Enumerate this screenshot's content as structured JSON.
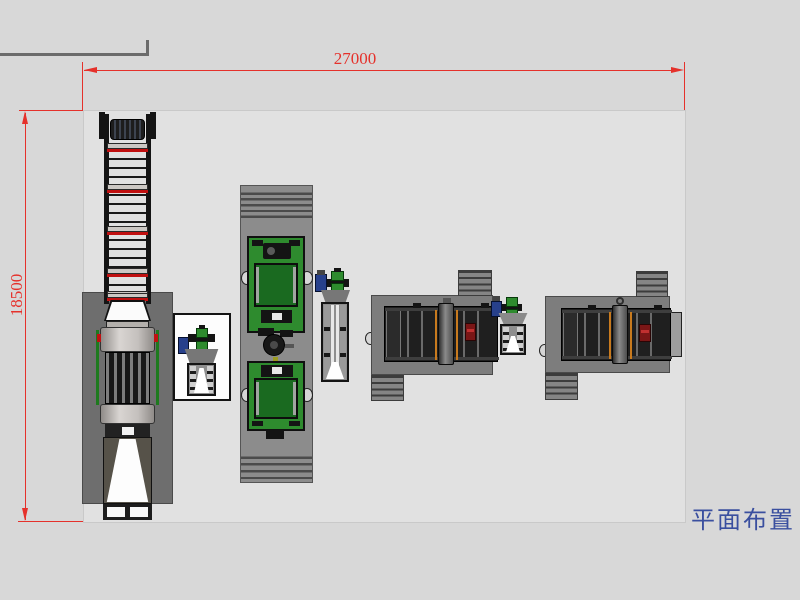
{
  "drawing": {
    "caption": "平面布置",
    "caption_color": "#3a4f9f",
    "dimension_color": "#e5312b",
    "dim_top_label": "27000",
    "dim_left_label": "18500",
    "outer_bg": "#d8d8d8",
    "area_bg": "#e1e1e1"
  },
  "palette": {
    "pad_gray": "#6e6e6e",
    "platform_gray": "#8c8c8c",
    "machine_green": "#2e8b2e",
    "belt_green": "#1a6a20",
    "machine_black": "#1f1f1f",
    "alarm_red": "#c01010",
    "accent_orange": "#c87a1e",
    "motor_blue": "#27408b",
    "frame_gray": "#6b6b6b"
  },
  "equipment": [
    "frame-corner",
    "bucket-elevator",
    "feed-truck",
    "truck-pad",
    "feeder-cabinet",
    "mixer-platform",
    "mixer-1",
    "mixer-2",
    "screw-elevator",
    "packing-line-1",
    "packing-line-2"
  ]
}
